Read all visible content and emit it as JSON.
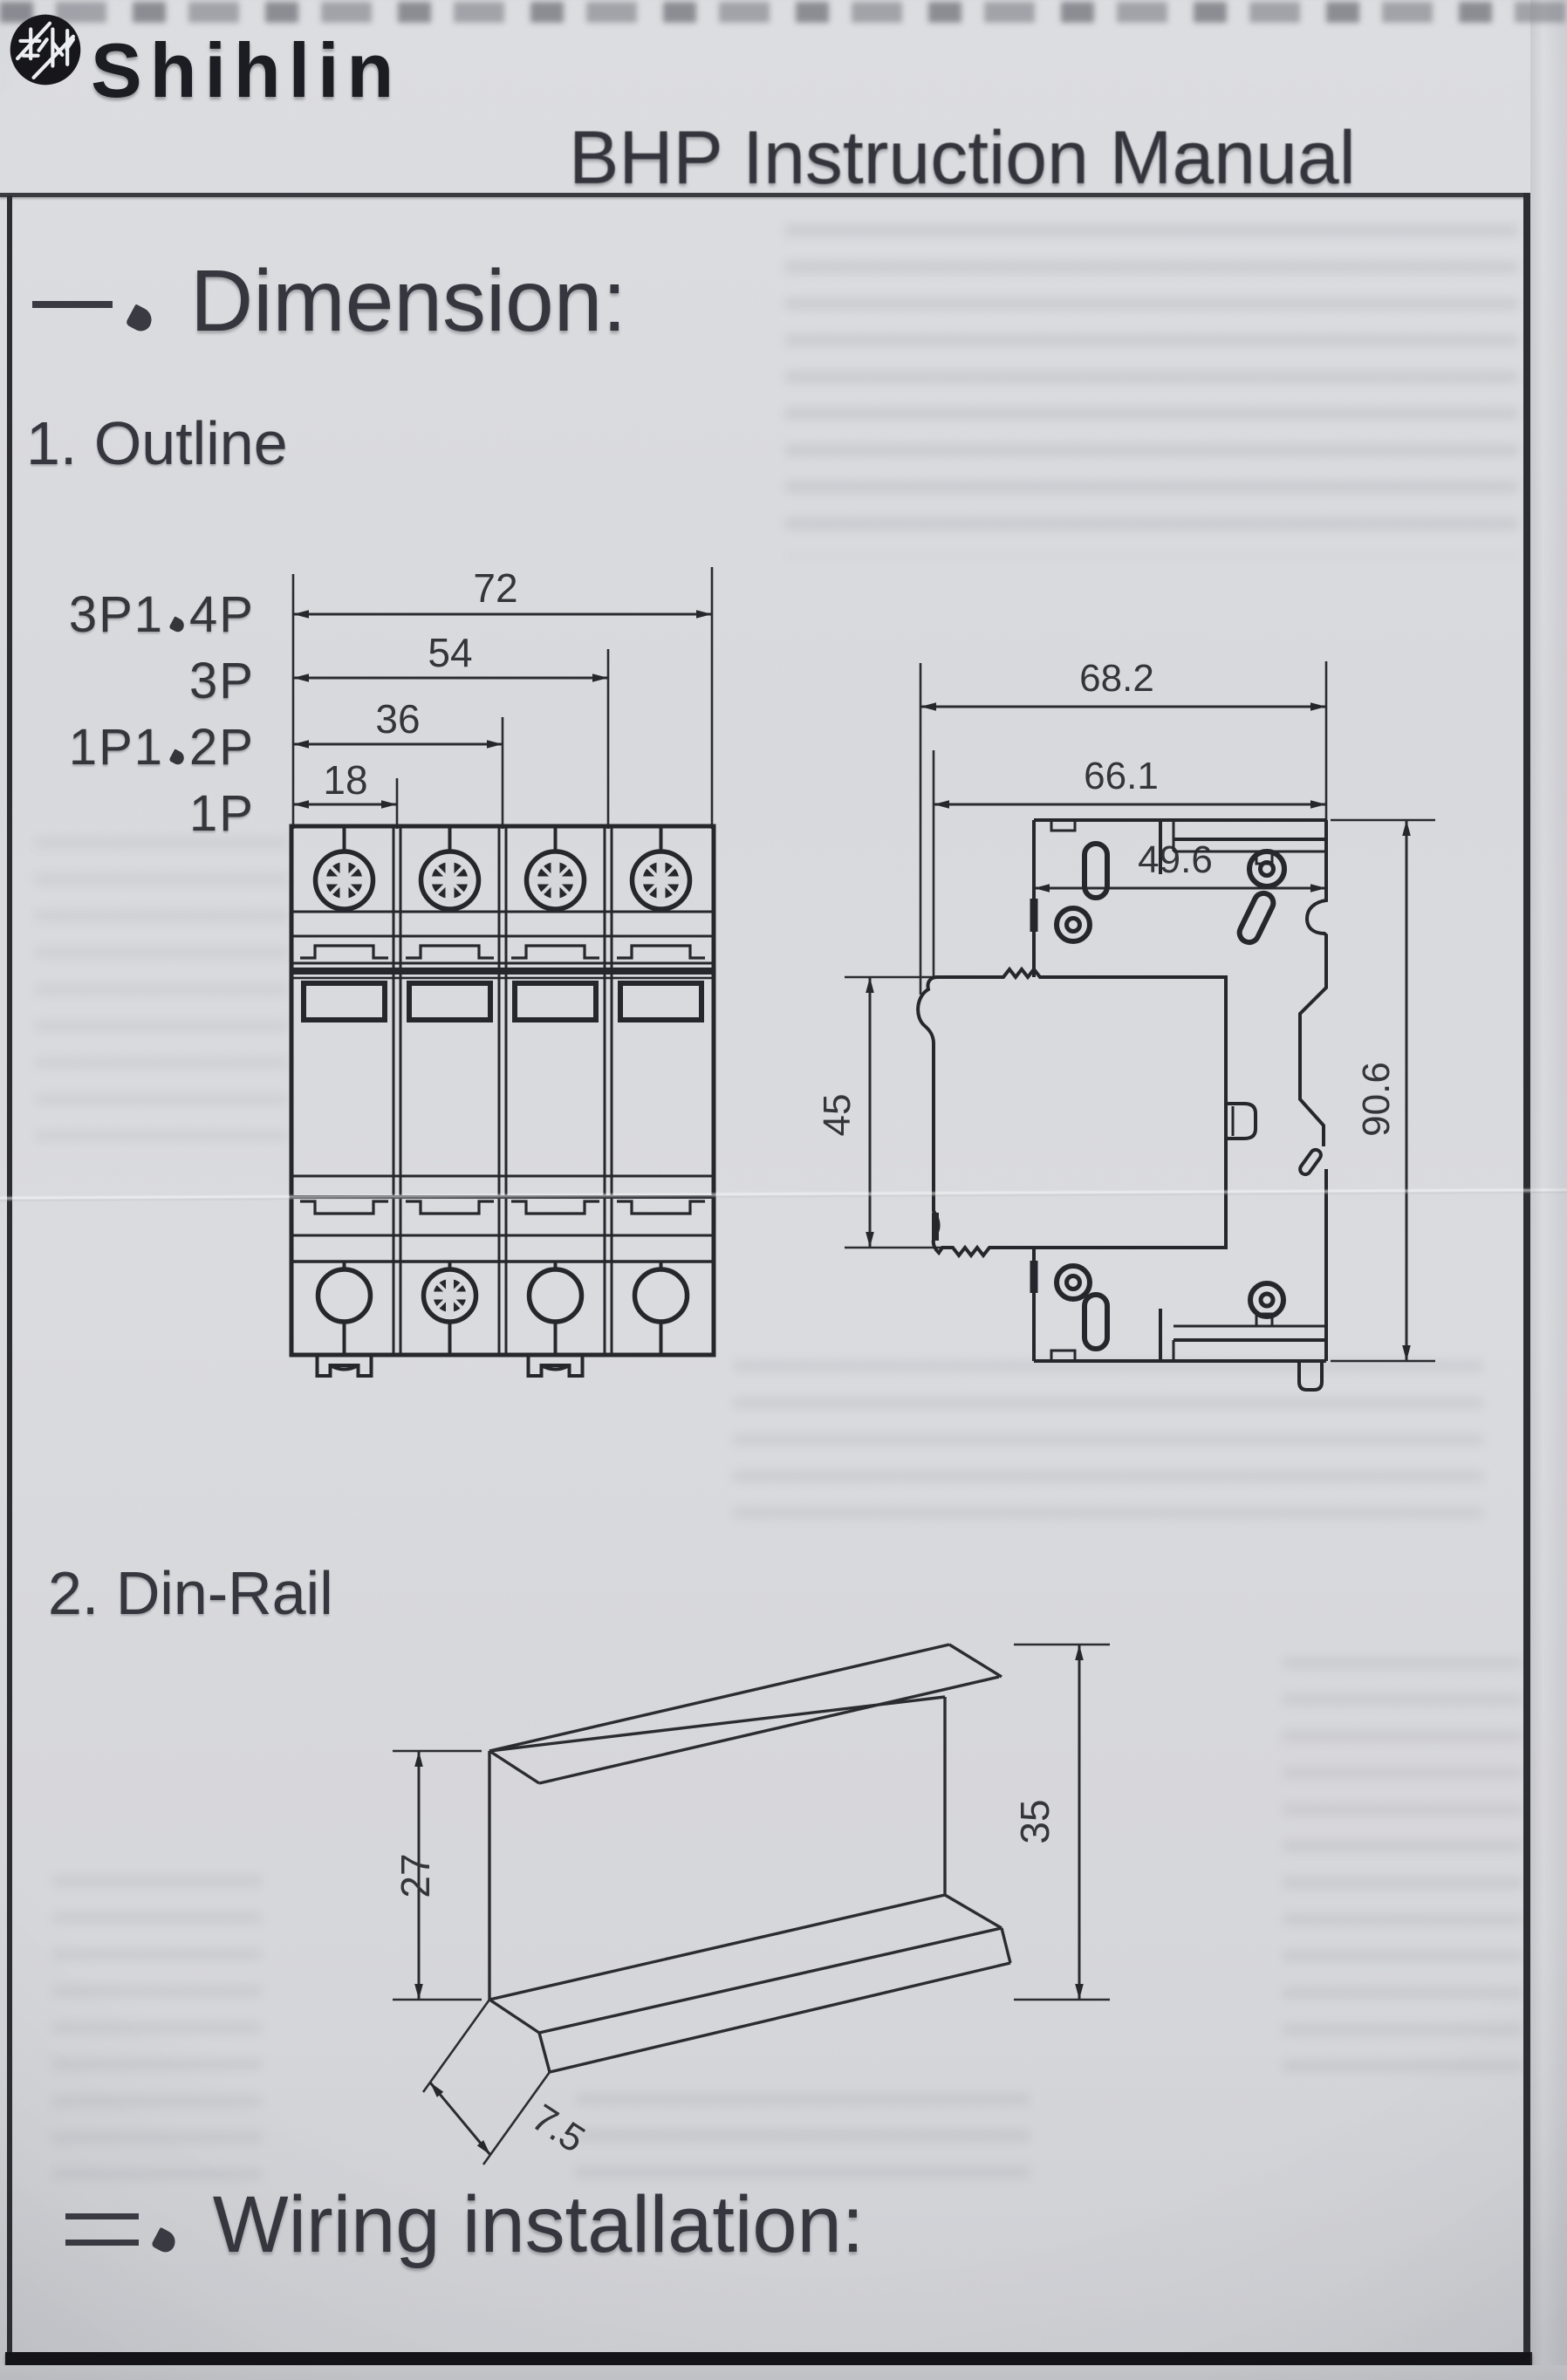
{
  "header": {
    "brand": "Shihlin",
    "title": "BHP Instruction Manual"
  },
  "sections": {
    "dimension": {
      "numeral": "一、",
      "title": "Dimension:"
    },
    "outline": {
      "label": "1. Outline"
    },
    "dinrail": {
      "label": "2. Din-Rail"
    },
    "wiring": {
      "numeral": "二、",
      "title": "Wiring installation:"
    }
  },
  "outline": {
    "front_view": {
      "pole_labels": [
        "3P1、4P",
        "3P",
        "1P1、2P",
        "1P"
      ],
      "width_dims": [
        "72",
        "54",
        "36",
        "18"
      ]
    },
    "side_view": {
      "depth_dims": [
        "68.2",
        "66.1",
        "49.6"
      ],
      "front_height": "45",
      "overall_height": "90.6"
    }
  },
  "dinrail": {
    "dims": {
      "web_height": "27",
      "overall_height": "35",
      "flange_depth": "7.5"
    }
  },
  "colors": {
    "paper": "#d6d7db",
    "ink": "#26272c",
    "text": "#34353b"
  }
}
